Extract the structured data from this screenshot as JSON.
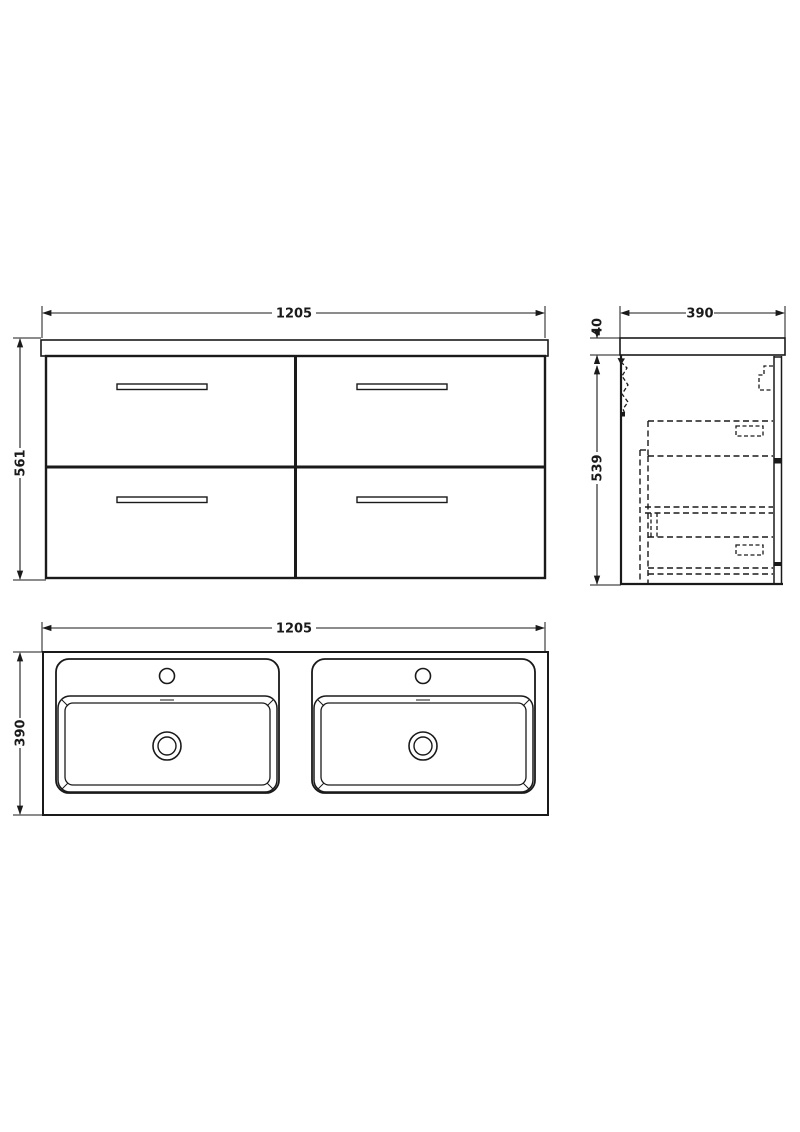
{
  "drawing": {
    "views": {
      "front": {
        "width_mm": "1205",
        "height_mm": "561"
      },
      "side": {
        "depth_mm": "390",
        "worktop_thickness_mm": "40",
        "cabinet_height_mm": "539"
      },
      "plan": {
        "width_mm": "1205",
        "depth_mm": "390"
      }
    },
    "colors": {
      "line": "#1a1a1a",
      "background": "#ffffff"
    }
  }
}
